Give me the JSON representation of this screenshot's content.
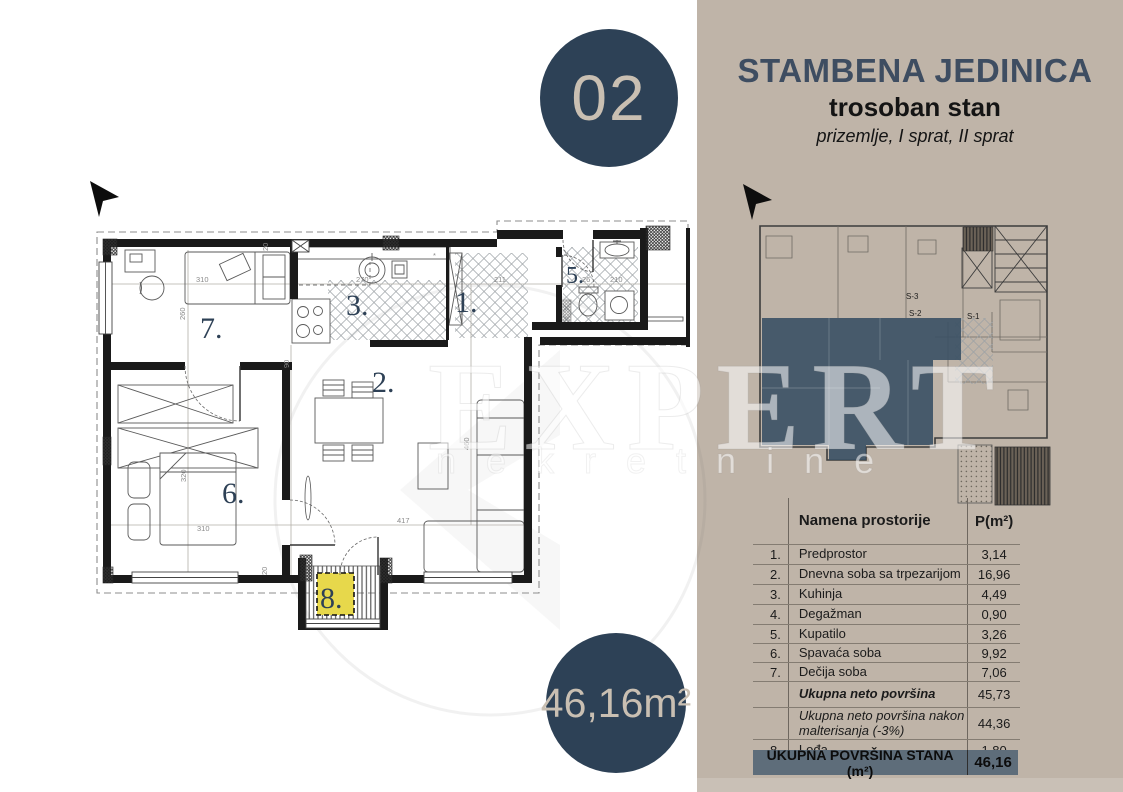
{
  "badges": {
    "unit": "02",
    "area": "46,16m²"
  },
  "panel": {
    "title": "STAMBENA JEDINICA",
    "subtitle": "trosoban stan",
    "floors": "prizemlje, I sprat, II sprat"
  },
  "watermark": {
    "brand": "EXPERT",
    "sub": "nekretnine"
  },
  "floor_plan": {
    "rooms": [
      {
        "num": "7."
      },
      {
        "num": "3."
      },
      {
        "num": "1."
      },
      {
        "num": "5."
      },
      {
        "num": "2."
      },
      {
        "num": "6."
      },
      {
        "num": "8."
      }
    ],
    "dims": [
      "260",
      "310",
      "270",
      "211",
      "26",
      "210",
      "20",
      "90",
      "320",
      "310",
      "417",
      "460",
      "20"
    ],
    "marks": [
      "*",
      "*"
    ]
  },
  "mini_plan": {
    "labels": [
      "S-3",
      "S-2",
      "S-1"
    ]
  },
  "table": {
    "col_name": "Namena prostorije",
    "col_area": "P(m²)",
    "rows": [
      {
        "num": "1.",
        "name": "Predprostor",
        "value": "3,14"
      },
      {
        "num": "2.",
        "name": "Dnevna soba sa trpezarijom",
        "value": "16,96"
      },
      {
        "num": "3.",
        "name": "Kuhinja",
        "value": "4,49"
      },
      {
        "num": "4.",
        "name": "Degažman",
        "value": "0,90"
      },
      {
        "num": "5.",
        "name": "Kupatilo",
        "value": "3,26"
      },
      {
        "num": "6.",
        "name": "Spavaća soba",
        "value": "9,92"
      },
      {
        "num": "7.",
        "name": "Dečija soba",
        "value": "7,06"
      },
      {
        "num": "",
        "name": "Ukupna neto površina",
        "value": "45,73"
      },
      {
        "num": "",
        "name": "Ukupna neto površina nakon malterisanja (-3%)",
        "value": "44,36"
      },
      {
        "num": "8.",
        "name": "Lođa",
        "value": "1,80"
      }
    ],
    "footer": {
      "label": "UKUPNA POVRŠINA STANA (m²)",
      "value": "46,16"
    }
  }
}
